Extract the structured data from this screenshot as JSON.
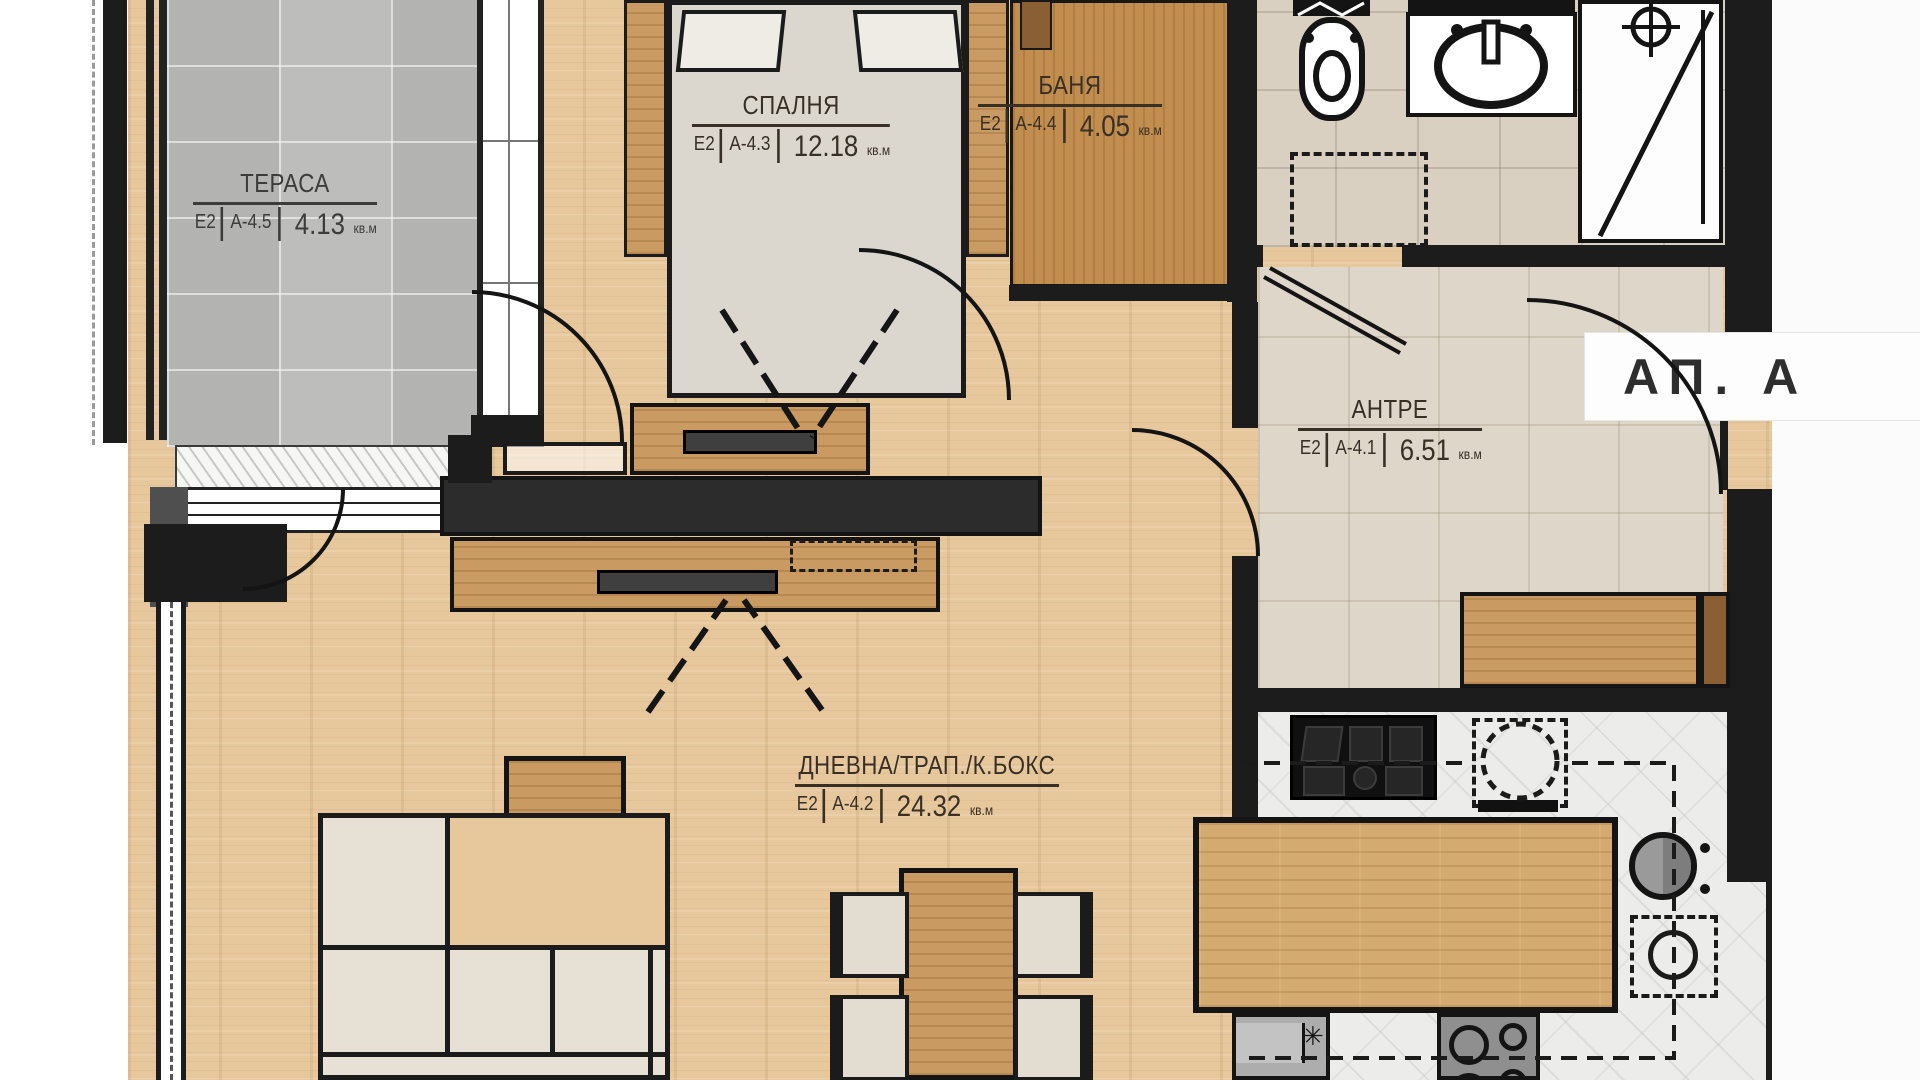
{
  "plan": {
    "unit_badge": "АП. А",
    "rooms": [
      {
        "key": "terrace",
        "name": "ТЕРАСА",
        "zone": "Е2",
        "code": "А-4.5",
        "area": "4.13",
        "unit": "кв.м"
      },
      {
        "key": "bedroom",
        "name": "СПАЛНЯ",
        "zone": "Е2",
        "code": "А-4.3",
        "area": "12.18",
        "unit": "кв.м"
      },
      {
        "key": "bathroom",
        "name": "БАНЯ",
        "zone": "Е2",
        "code": "А-4.4",
        "area": "4.05",
        "unit": "кв.м"
      },
      {
        "key": "hallway",
        "name": "АНТРЕ",
        "zone": "Е2",
        "code": "А-4.1",
        "area": "6.51",
        "unit": "кв.м"
      },
      {
        "key": "living",
        "name": "ДНЕВНА/ТРАП./К.БОКС",
        "zone": "Е2",
        "code": "А-4.2",
        "area": "24.32",
        "unit": "кв.м"
      }
    ],
    "glyphs": {
      "asterisk": "✳"
    },
    "fixtures": [
      "toilet",
      "washbasin",
      "washing-machine",
      "cooktop",
      "kitchen-sink",
      "extractor-fan",
      "shaft-marker"
    ],
    "colors": {
      "wall": "#1c1c1c",
      "media_wall": "#2c2c2c",
      "wood_floor": "#e7c89d",
      "wood_furniture": "#c99b62",
      "terrace_tile": "#bdbdbb",
      "bath_tile": "#d9d0c2",
      "hall_tile": "#ded6c8",
      "kitchen_marble": "#ececea",
      "label_ink": "#383026",
      "sofa_fabric": "#e3ddd1",
      "appliance_gray": "#a9a9a9"
    }
  }
}
